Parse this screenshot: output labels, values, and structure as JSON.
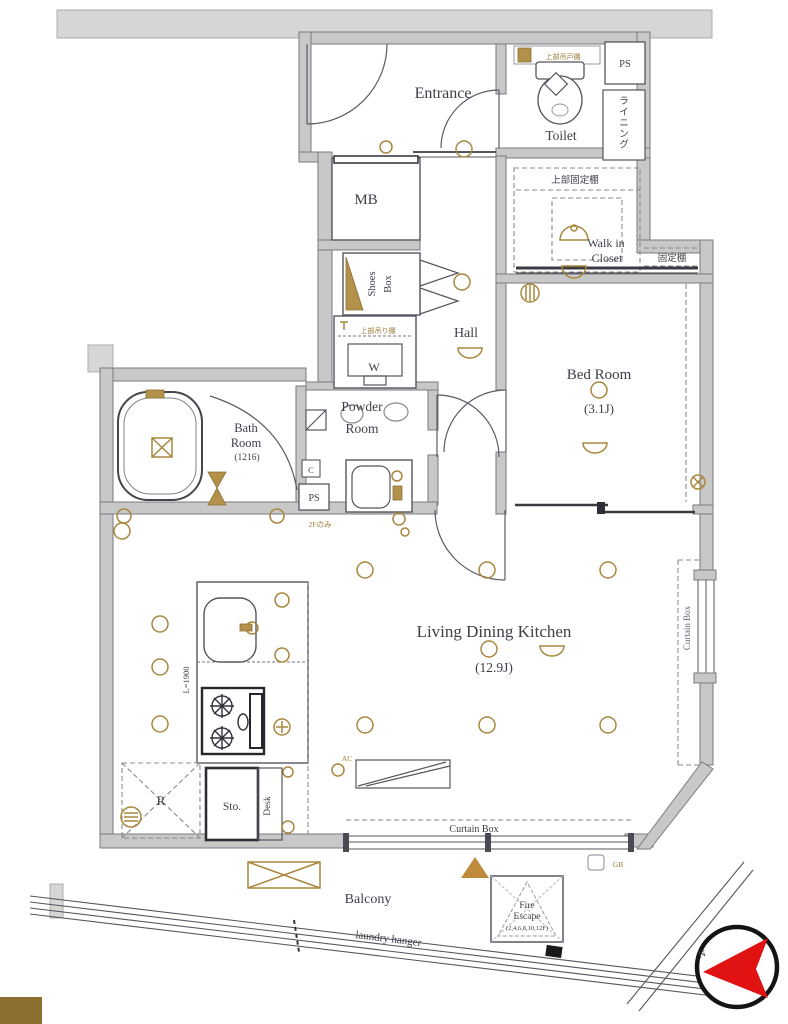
{
  "rooms": {
    "entrance": "Entrance",
    "toilet": "Toilet",
    "mb": "MB",
    "shoes_line1": "Shoes",
    "shoes_line2": "Box",
    "hall": "Hall",
    "wic_line1": "Walk in",
    "wic_line2": "Closet",
    "bed": "Bed Room",
    "bed_size": "(3.1J)",
    "bath_line1": "Bath",
    "bath_line2": "Room",
    "bath_size": "(1216)",
    "powder_line1": "Powder",
    "powder_line2": "Room",
    "ldk": "Living Dining Kitchen",
    "ldk_size": "(12.9J)",
    "storage": "Sto.",
    "desk": "Desk",
    "fridge": "R",
    "washer": "W",
    "balcony": "Balcony"
  },
  "labels": {
    "ps_top": "PS",
    "ps_powder": "PS",
    "cold_duct": "C",
    "lining": "ライニング",
    "toilet_upper_shelf": "上部吊戸棚",
    "upper_fixed_shelf": "上部固定棚",
    "fixed_shelf": "固定棚",
    "washer_upper_shelf": "上部吊り棚",
    "counter_length": "L=1900",
    "ac": "AC",
    "floor_note": "2Fのみ",
    "curtain_box_bottom": "Curtain Box",
    "curtain_box_right": "Curtain Box",
    "fire_escape_line1": "Fire",
    "fire_escape_line2": "Escape",
    "fire_escape_line3": "(2,4,6,8,10,12F)",
    "laundry_hanger": "laundry hanger",
    "gas_box": "GB",
    "north": "N"
  },
  "colors": {
    "wall": "#c8c8c8",
    "slab": "#d6d6d6",
    "outline": "#70707a",
    "accent_gold": "#a8873d",
    "compass_red": "#e01212",
    "corner_block": "#8d7030",
    "text": "#3e3f49"
  }
}
